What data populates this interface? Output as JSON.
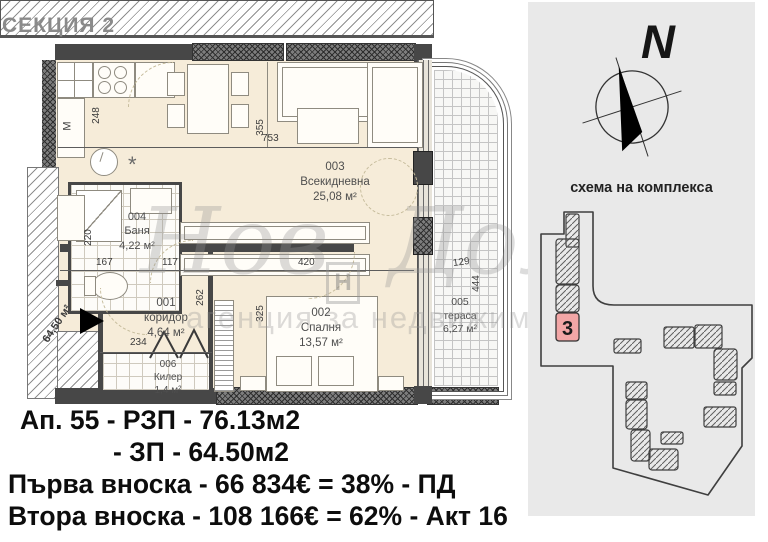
{
  "section_label": "СЕКЦИЯ 2",
  "floor_plan": {
    "rooms": [
      {
        "number": "001",
        "name": "коридор",
        "area": "4,64 м²"
      },
      {
        "number": "002",
        "name": "Спалня",
        "area": "13,57 м²"
      },
      {
        "number": "003",
        "name": "Всекидневна",
        "area": "25,08 м²"
      },
      {
        "number": "004",
        "name": "Баня",
        "area": "4,22 м²"
      },
      {
        "number": "005",
        "name": "тераса",
        "area": "6,27 м²"
      },
      {
        "number": "006",
        "name": "Килер",
        "area": "1,4 м²"
      }
    ],
    "dimensions": {
      "d248": "248",
      "d753": "753",
      "d355": "355",
      "d117": "117",
      "d167": "167",
      "d220": "220",
      "d420": "420",
      "d262": "262",
      "d325": "325",
      "d234": "234",
      "d129": "129",
      "d444": "444"
    },
    "side_area_label": "64,50 м²",
    "symbols": {
      "appliance_label": "М",
      "vent_symbol": "*"
    }
  },
  "watermark": {
    "brand": "Нов Дом",
    "logo_letter": "Н",
    "tagline": "агенция за недвижими имоти"
  },
  "site_panel": {
    "north_letter": "N",
    "title": "схема на комплекса",
    "building_number": "3"
  },
  "summary": {
    "line1": "Ап. 55 - РЗП - 76.13м2",
    "line2": "- ЗП - 64.50м2",
    "line3": "Първа вноска - 66 834€ = 38% - ПД",
    "line4": "Втора вноска - 108 166€ = 62% - Акт 16"
  },
  "colors": {
    "plan_floor": "#f6ecd9",
    "wall": "#474747",
    "panel_bg": "#e9e9e9",
    "highlight_red": "#f2a6a6",
    "text": "#0d0d0d"
  }
}
